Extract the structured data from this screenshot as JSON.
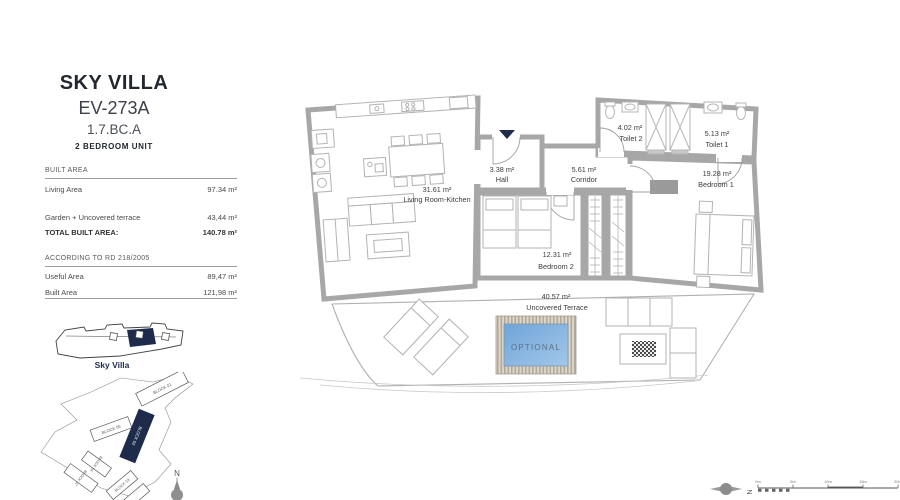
{
  "title_block": {
    "project": "SKY VILLA",
    "unit_code": "EV-273A",
    "unit_ref": "1.7.BC.A",
    "unit_type": "2 BEDROOM UNIT"
  },
  "area_table": {
    "section1_header": "BUILT AREA",
    "section1_rows": [
      {
        "label": "Living Area",
        "value": "97.34 m²"
      },
      {
        "label": "Garden + Uncovered terrace",
        "value": "43,44 m²"
      },
      {
        "label": "TOTAL BUILT AREA:",
        "value": "140.78 m²"
      }
    ],
    "section2_header": "ACCORDING TO RD 218/2005",
    "section2_rows": [
      {
        "label": "Useful Area",
        "value": "89,47 m²"
      },
      {
        "label": "Built Area",
        "value": "121,98 m²"
      }
    ]
  },
  "key_plan": {
    "label": "Sky Villa"
  },
  "site_plan": {
    "north_label": "N",
    "blocks": [
      {
        "label": "BLOCK 01"
      },
      {
        "label": "BLOCK 05"
      },
      {
        "label": "BLOCK 02"
      },
      {
        "label": "BLOCK 04"
      },
      {
        "label": "BLOCK 07"
      },
      {
        "label": "BLOCK 03"
      }
    ]
  },
  "floor_plan": {
    "rooms": [
      {
        "name": "Hall",
        "area": "3.38 m²"
      },
      {
        "name": "Corridor",
        "area": "5.61 m²"
      },
      {
        "name": "Living Room-Kitchen",
        "area": "31.61 m²"
      },
      {
        "name": "Toilet 2",
        "area": "4.02 m²"
      },
      {
        "name": "Toilet 1",
        "area": "5.13 m²"
      },
      {
        "name": "Bedroom 1",
        "area": "19.28 m²"
      },
      {
        "name": "Bedroom 2",
        "area": "12.31 m²"
      },
      {
        "name": "Uncovered Terrace",
        "area": "40.57 m²"
      }
    ],
    "pool_label": "OPTIONAL"
  },
  "footer": {
    "compass_label": "N",
    "scale_labels": [
      "0m",
      "5m",
      "10m",
      "15m",
      "20m"
    ]
  },
  "colors": {
    "accent_navy": "#1e2b4a",
    "wall_gray": "#a7a7a7",
    "pool_blue": "#79aede",
    "pool_text": "#5d7186"
  }
}
